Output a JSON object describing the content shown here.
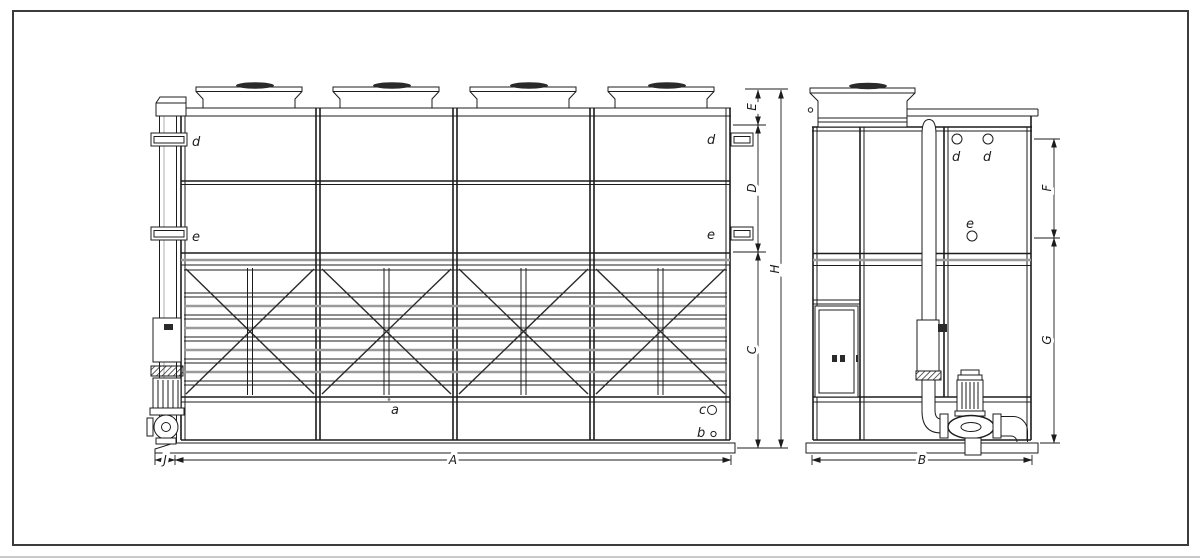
{
  "front_view": {
    "panel_labels": {
      "top_left": "d",
      "top_right": "d",
      "mid_left": "e",
      "mid_right": "e"
    },
    "basin_labels": {
      "a": "a",
      "b": "b",
      "c": "c"
    },
    "dims": {
      "A": "A",
      "C": "C",
      "D": "D",
      "E": "E",
      "H": "H",
      "J": "J"
    }
  },
  "side_view": {
    "pipe_labels": {
      "d_left": "d",
      "d_right": "d",
      "e": "e"
    },
    "dims": {
      "B": "B",
      "F": "F",
      "G": "G"
    }
  },
  "colors": {
    "line": "#1c1c1c",
    "gray_louver": "#9a9a9a",
    "background": "#ffffff",
    "fan_hub": "#1f1f1f"
  }
}
